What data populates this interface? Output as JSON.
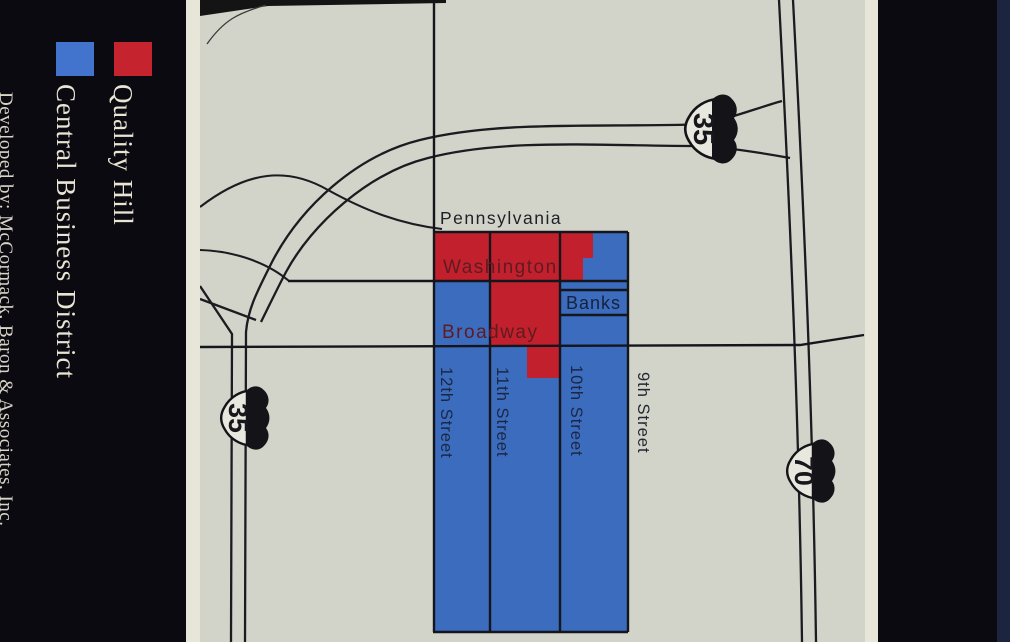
{
  "title_band": {
    "title": "The New Quality Hill"
  },
  "legend": {
    "items": [
      {
        "label": "Quality Hill",
        "swatch_color": "#c5242f"
      },
      {
        "label": "Central Business District",
        "swatch_color": "#4273cd"
      }
    ],
    "credit": "Developed by: McCormack, Baron & Associates, Inc."
  },
  "map": {
    "streets": {
      "pennsylvania": "Pennsylvania",
      "washington": "Washington",
      "broadway": "Broadway",
      "banks": "Banks",
      "street12": "12th Street",
      "street11": "11th Street",
      "street10": "10th Street",
      "street9": "9th Street"
    },
    "shields": {
      "north35": "35",
      "west35": "35",
      "east70": "70"
    },
    "colors": {
      "quality_hill_red": "#c3202d",
      "cbd_blue": "#3b6cbe",
      "map_background": "#d2d4ca",
      "road_line": "#1b1b20",
      "street_name_text": "#5f1b20"
    }
  }
}
